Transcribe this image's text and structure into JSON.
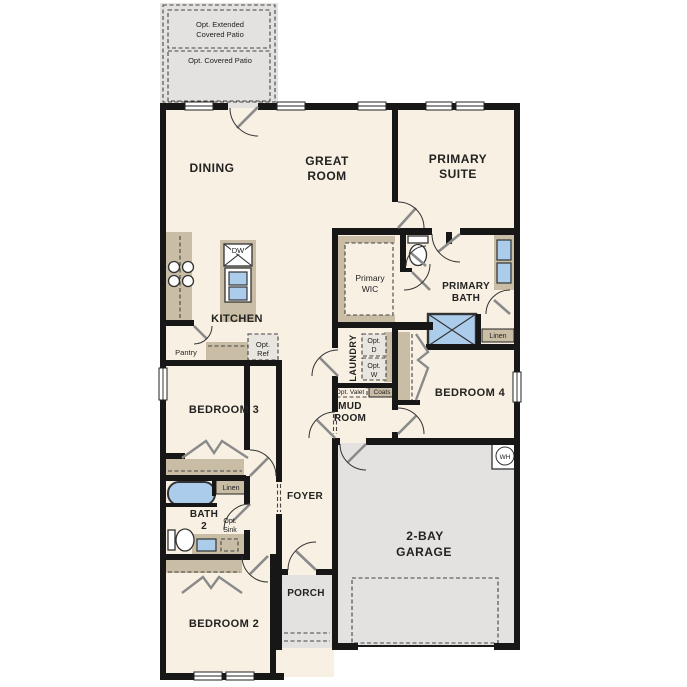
{
  "title": "Single-story floor plan",
  "colors": {
    "background": "#ffffff",
    "floor": "#f8f0e2",
    "wall": "#171717",
    "cabinet_tan": "#c9bda5",
    "concrete_gray": "#e3e2e0",
    "fixture_blue": "#abccea",
    "optional_fill": "#e9e6df",
    "text": "#222222"
  },
  "labels": {
    "patio_extended": [
      "Opt. Extended",
      "Covered Patio"
    ],
    "patio_covered": "Opt. Covered Patio",
    "dining": "DINING",
    "great_room": [
      "GREAT",
      "ROOM"
    ],
    "primary_suite": [
      "PRIMARY",
      "SUITE"
    ],
    "kitchen": "KITCHEN",
    "dishwasher": "DW",
    "pantry": "Pantry",
    "opt_ref": [
      "Opt.",
      "Ref"
    ],
    "primary_wic": [
      "Primary",
      "WIC"
    ],
    "primary_bath": [
      "PRIMARY",
      "BATH"
    ],
    "linen_primary": "Linen",
    "laundry": "LAUNDRY",
    "opt_dryer": [
      "Opt.",
      "D"
    ],
    "opt_washer": [
      "Opt.",
      "W"
    ],
    "opt_valet": "Opt. Valet",
    "coats": "Coats",
    "mud_room": [
      "MUD",
      "ROOM"
    ],
    "bedroom_4": "BEDROOM 4",
    "bedroom_3": "BEDROOM 3",
    "linen_bath2": "Linen",
    "bath_2": [
      "BATH",
      "2"
    ],
    "opt_sink": [
      "Opt.",
      "Sink"
    ],
    "bedroom_2": "BEDROOM 2",
    "foyer": "FOYER",
    "porch": "PORCH",
    "garage": [
      "2-BAY",
      "GARAGE"
    ],
    "water_heater": "WH"
  }
}
